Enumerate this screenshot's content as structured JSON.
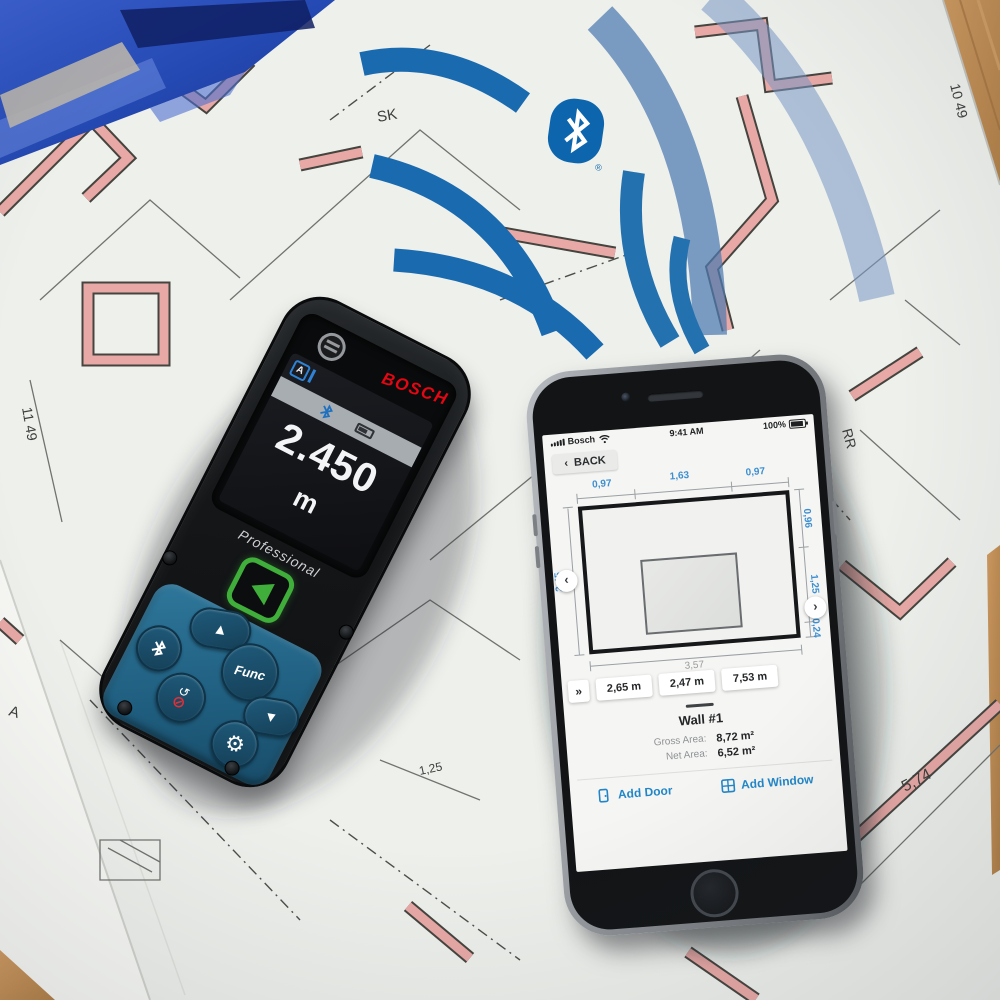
{
  "colors": {
    "bosch_red": "#e30613",
    "bluetooth_blue": "#0d66ad",
    "arc_blue": "#1a6ab0",
    "keypad_blue": "#27688c",
    "measure_green": "#3fae3a",
    "app_blue": "#2186c8",
    "dim_blue": "#3d8fd2",
    "wall_pink": "#e8a9a6"
  },
  "blueprint": {
    "labels": [
      "RR",
      "SK",
      "10 49",
      "11 49",
      "RR",
      "5,74",
      "80 IL.",
      "1,25",
      "A"
    ]
  },
  "device": {
    "brand": "BOSCH",
    "display": {
      "mode_icon": "A",
      "value": "2.450",
      "unit": "m"
    },
    "label": "Professional",
    "buttons": {
      "func": "Func"
    }
  },
  "icons": {
    "back_chevron": "‹",
    "prev_arrow": "‹",
    "next_arrow": "›",
    "continue_chevrons": "»",
    "up_triangle": "▲",
    "down_triangle": "▼",
    "gear": "⚙",
    "power_slash": "⊘",
    "return_arrow": "↺"
  },
  "phone": {
    "status": {
      "carrier": "Bosch",
      "time": "9:41 AM",
      "battery": "100%"
    },
    "back_label": "BACK",
    "diagram": {
      "top_dims": [
        "0,97",
        "1,63",
        "0,97"
      ],
      "left_dim": "2,45",
      "right_dims": [
        "0,96",
        "1,25",
        "0,24"
      ],
      "bottom_dim": "3,57"
    },
    "measurements": [
      "2,65 m",
      "2,47 m",
      "7,53 m"
    ],
    "wall_title": "Wall #1",
    "gross_label": "Gross Area:",
    "gross_value": "8,72 m²",
    "net_label": "Net Area:",
    "net_value": "6,52 m²",
    "actions": {
      "door": "Add Door",
      "window": "Add Window"
    }
  }
}
